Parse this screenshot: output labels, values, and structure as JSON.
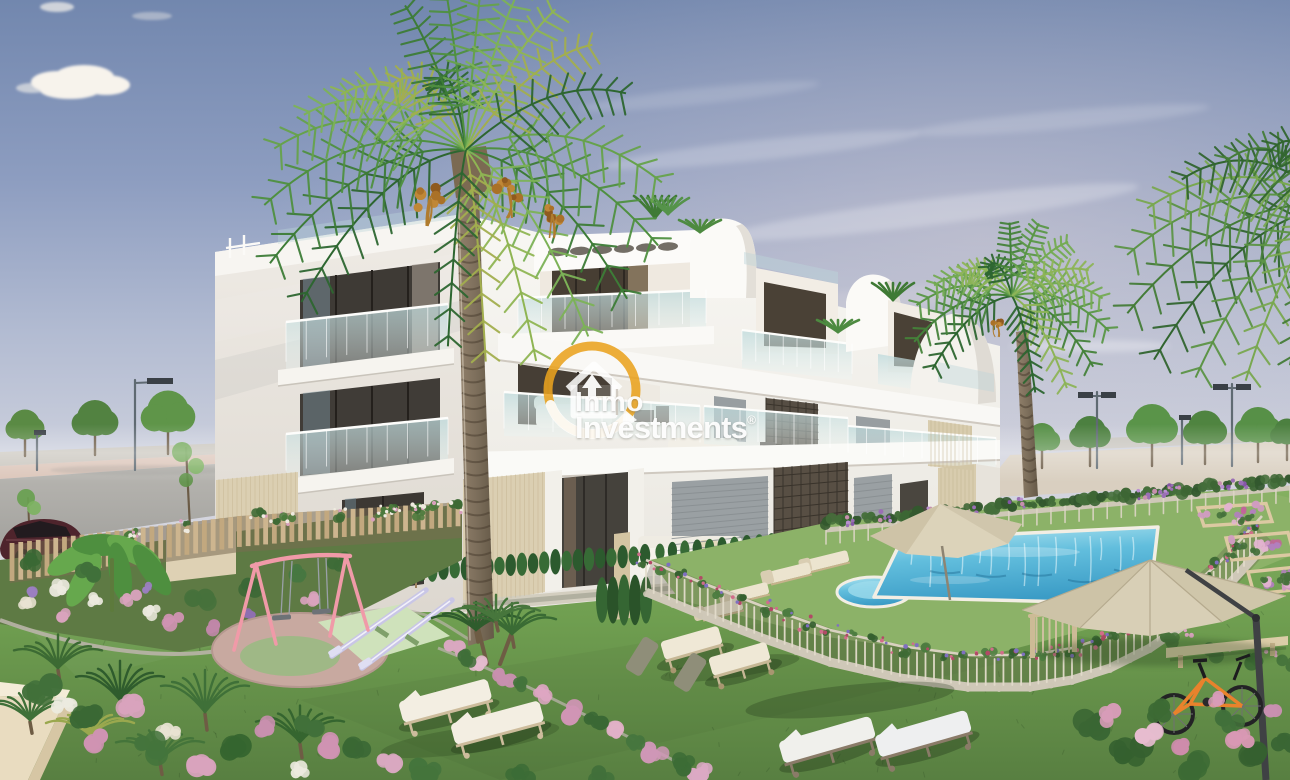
{
  "image": {
    "kind": "real-estate-3d-render",
    "alt": "New-build white apartment complex with communal swimming pool, landscaped lawn, playground, sun loungers and palm trees under a blue sky",
    "watermark": {
      "brand_top": "Inmo",
      "brand_bottom": "Investments",
      "registered_mark": "®",
      "arc_color": "#E9A31F",
      "text_color": "#FFFFFF"
    },
    "palette": {
      "sky_top": "#7287AE",
      "sky_horizon": "#D8D7DE",
      "building_white": "#F6F5F2",
      "lawn_green": "#6F9E50",
      "pool_blue": "#4FB2D6",
      "parasol_beige": "#D9D0BA",
      "swing_pink": "#F09AA8",
      "seesaw_lavender": "#C9C6E6",
      "bike_orange": "#E8822C",
      "palm_green": "#4E8C42",
      "fence_wood": "#C9B392",
      "flower_pink": "#D9A8C0"
    }
  }
}
